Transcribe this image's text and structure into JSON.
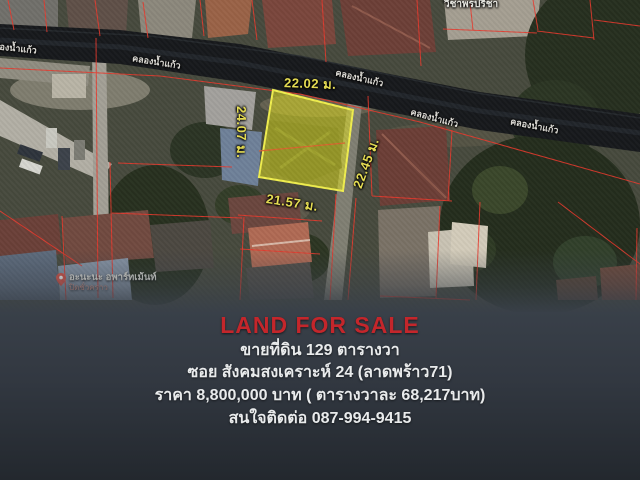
{
  "map": {
    "dimensions": {
      "top": "22.02 ม.",
      "left": "24.07 ม.",
      "right": "22.45 ม.",
      "bottom": "21.57 ม."
    },
    "canal_label": "คลองน้ำแก้ว",
    "street_top_label": "วิชาพรปรีชา",
    "poi": {
      "name": "อะนะนะ อพาร์ทเม้นท์",
      "status": "ปิดชั่วคราว"
    }
  },
  "panel": {
    "title": "LAND FOR SALE",
    "lines": [
      "ขายที่ดิน 129 ตารางวา",
      "ซอย สังคมสงเคราะห์ 24 (ลาดพร้าว71)",
      "ราคา 8,800,000 บาท ( ตารางวาละ 68,217บาท)",
      "สนใจติดต่อ 087-994-9415"
    ]
  },
  "colors": {
    "accent_red": "#c4262b",
    "text_white": "#e9ebec",
    "dim_yellow": "#e8df52",
    "parcel_red": "#e8392c",
    "plot_yellow": "#e6e41f"
  }
}
